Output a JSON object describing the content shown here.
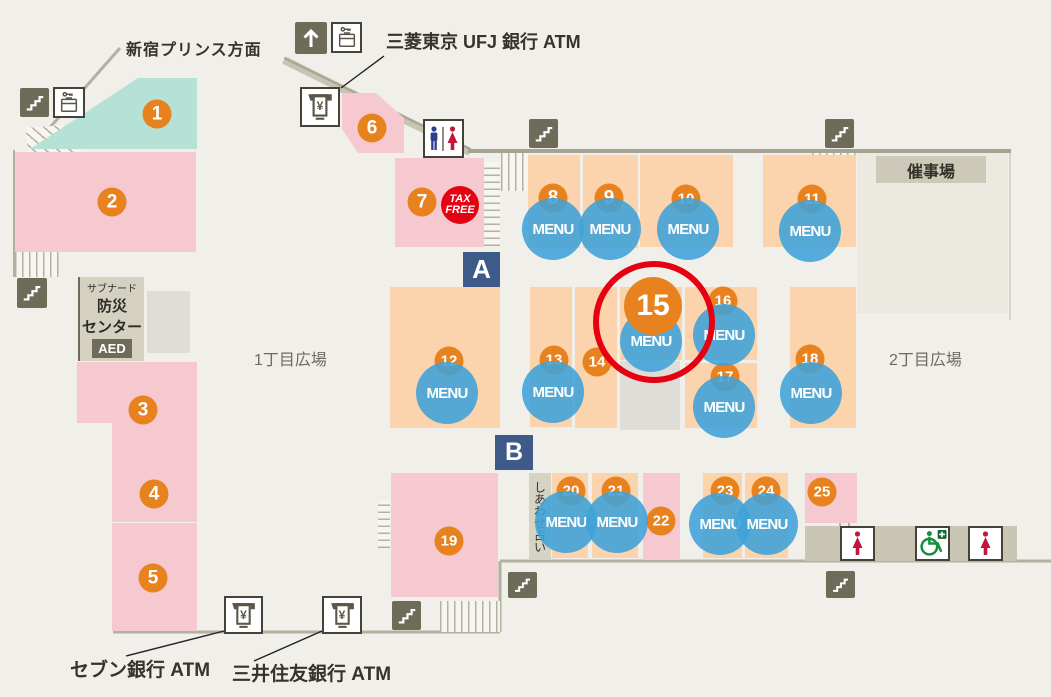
{
  "map": {
    "units": [
      "1",
      "2",
      "3",
      "4",
      "5",
      "6",
      "7",
      "8",
      "9",
      "10",
      "11",
      "12",
      "13",
      "14",
      "15",
      "16",
      "17",
      "18",
      "19",
      "20",
      "21",
      "22",
      "23",
      "24",
      "25"
    ],
    "menu_label": "MENU",
    "markers": {
      "a": "A",
      "b": "B"
    },
    "labels": {
      "prince_direction": "新宿プリンス方面",
      "ufj_atm": "三菱東京 UFJ 銀行 ATM",
      "seven_atm": "セブン銀行 ATM",
      "smbc_atm": "三井住友銀行 ATM",
      "event_hall": "催事場",
      "plaza_1chome": "1丁目広場",
      "plaza_2chome": "2丁目広場",
      "fortune_telling": "しあわせ占い",
      "disaster_center_line1": "サブナード",
      "disaster_center_line2": "防災",
      "disaster_center_line3": "センター",
      "aed": "AED",
      "tax_free_line1": "TAX",
      "tax_free_line2": "FREE",
      "yen_symbol": "¥"
    },
    "colors": {
      "unit_orange": "#e8821e",
      "menu_blue": "#3fa2d9",
      "shop_pink": "#f6c8cf",
      "shop_peach": "#fbd4ad",
      "shop_teal": "#b5e1d6",
      "highlight_red": "#e60012",
      "marker_navy": "#3d5a88",
      "icon_olive": "#6f6b59"
    },
    "highlighted_unit": "15"
  }
}
